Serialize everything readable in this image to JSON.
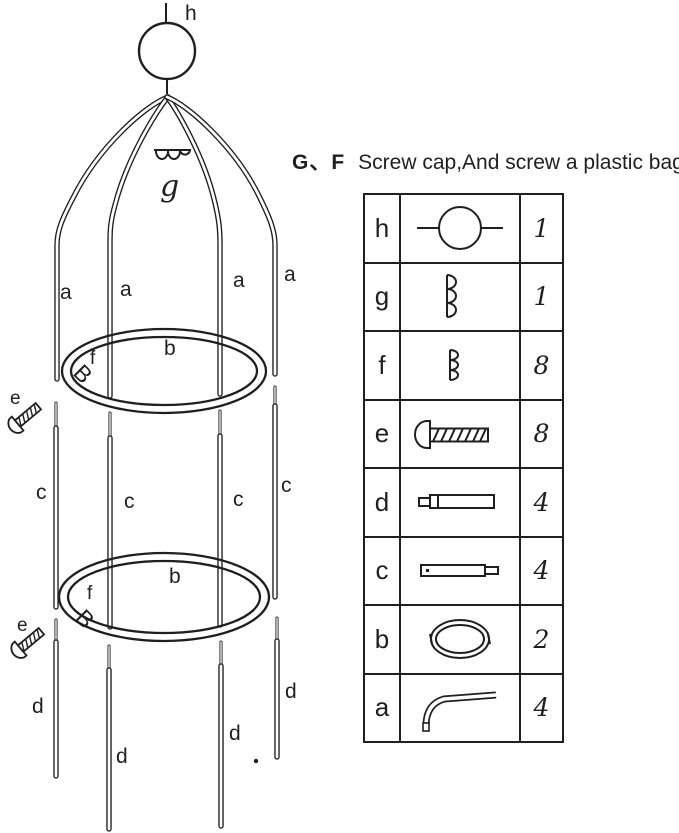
{
  "title": {
    "prefix": "G、F",
    "text": "Screw cap,And screw a plastic bag"
  },
  "diagram": {
    "finial_label": "h",
    "cap_label": "g",
    "clip_glyph": "B",
    "upper_rods": [
      "a",
      "a",
      "a",
      "a"
    ],
    "ring_labels": [
      "b",
      "b"
    ],
    "clip_labels": [
      "f",
      "f"
    ],
    "screw_labels": [
      "e",
      "e"
    ],
    "middle_rods": [
      "c",
      "c",
      "c",
      "c"
    ],
    "legs": [
      "d",
      "d",
      "d",
      "d"
    ]
  },
  "parts_table": {
    "rows": [
      {
        "label": "h",
        "qty": "1",
        "icon": "ball-finial"
      },
      {
        "label": "g",
        "qty": "1",
        "icon": "large-screw-cap"
      },
      {
        "label": "f",
        "qty": "8",
        "icon": "small-screw-cap"
      },
      {
        "label": "e",
        "qty": "8",
        "icon": "screw"
      },
      {
        "label": "d",
        "qty": "4",
        "icon": "leg-tube"
      },
      {
        "label": "c",
        "qty": "4",
        "icon": "middle-tube"
      },
      {
        "label": "b",
        "qty": "2",
        "icon": "ring"
      },
      {
        "label": "a",
        "qty": "4",
        "icon": "curved-rod"
      }
    ]
  },
  "colors": {
    "ink": "#1f1f1f",
    "background": "#ffffff"
  }
}
